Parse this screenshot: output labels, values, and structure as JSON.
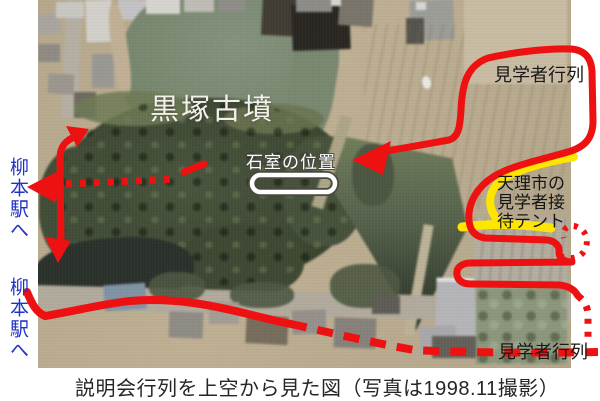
{
  "figure": {
    "caption": "説明会行列を上空から見た図（写真は1998.11撮影）"
  },
  "photo_labels": {
    "site_name": "黒塚古墳",
    "stone_chamber": "石室の位置",
    "visitor_queue_top": "見学者行列",
    "visitor_queue_bottom": "見学者行列",
    "tent": "天理市の\n見学者接\n待テント",
    "station_upper": "柳本駅へ",
    "station_lower": "柳本駅へ"
  },
  "colors": {
    "annotation_red": "#ee1111",
    "highlight_yellow": "#ffe600",
    "station_text_blue": "#2233c4",
    "photo_label_white": "#ffffff",
    "caption_black": "#262626"
  }
}
